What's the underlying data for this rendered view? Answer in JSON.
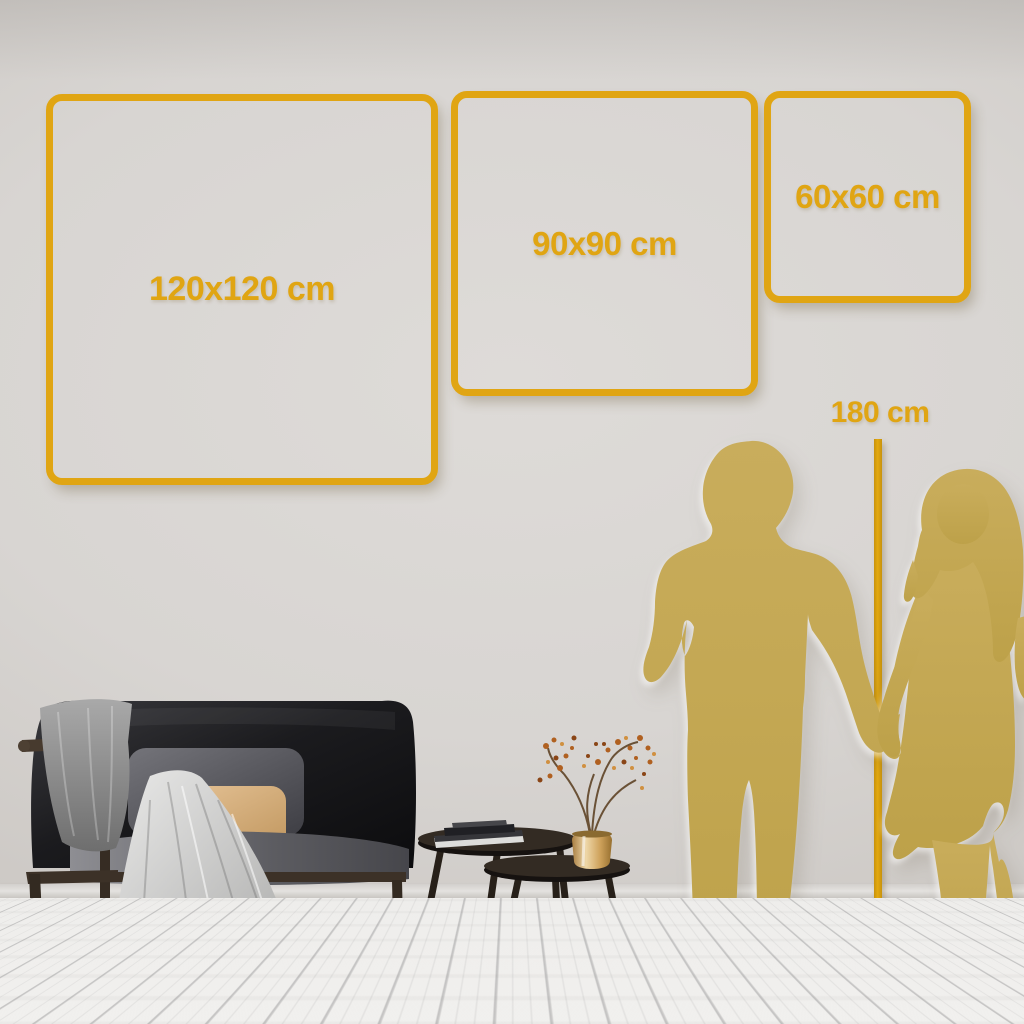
{
  "scene": {
    "title": "Wall art size comparison guide",
    "description": "Living-room wall mockup with three gold square outlines showing artwork sizes, a gold couple silhouette and a 180 cm height reference line, dark sofa with throw blanket, nesting coffee tables with books and a brass vase with dried branches"
  },
  "size_guide": {
    "frames": [
      {
        "name": "frame-120",
        "label": "120x120 cm",
        "width_cm": 120,
        "height_cm": 120
      },
      {
        "name": "frame-90",
        "label": "90x90 cm",
        "width_cm": 90,
        "height_cm": 90
      },
      {
        "name": "frame-60",
        "label": "60x60 cm",
        "width_cm": 60,
        "height_cm": 60
      }
    ],
    "height_reference": {
      "label": "180 cm",
      "value_cm": 180
    }
  },
  "colors": {
    "accent_gold": "#e0a513",
    "silhouette_gold": "#c4a854",
    "wall": "#d6d3d0",
    "floor": "#f2f1ef",
    "sofa_dark": "#17171a",
    "pillow_tan": "#d9b489",
    "plant_rust": "#b06020"
  },
  "illustrations": {
    "sofa": "dark velvet sofa with wood frame, gray cushions, tan pillow and draped gray blankets",
    "tables": "two round nesting coffee tables with a stack of books and a brass vase holding berry branches",
    "man": "gold silhouette of a standing man",
    "woman": "gold silhouette of a long-haired woman holding the man's hand"
  }
}
